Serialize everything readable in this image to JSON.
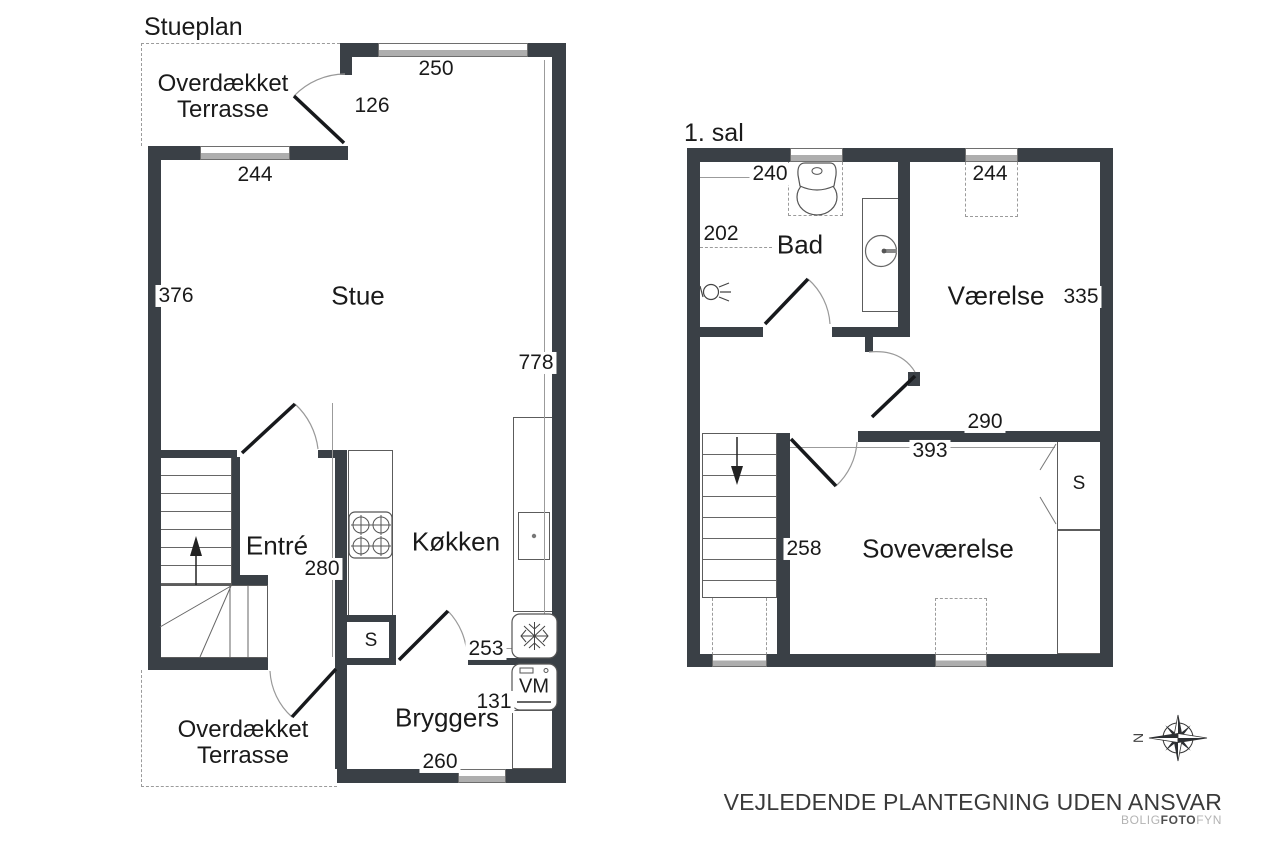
{
  "ground_floor": {
    "title": "Stueplan",
    "terrace_top": {
      "line1": "Overdækket",
      "line2": "Terrasse"
    },
    "terrace_bottom": {
      "line1": "Overdækket",
      "line2": "Terrasse"
    },
    "rooms": {
      "stue": "Stue",
      "entre": "Entré",
      "kokken": "Køkken",
      "bryggers": "Bryggers",
      "closet": "S"
    },
    "appliances": {
      "washer": "VM"
    },
    "dims": {
      "top_window": "250",
      "terrace_door": "126",
      "left_window": "244",
      "stue_side": "376",
      "right_side": "778",
      "entre_width": "280",
      "kokken_width": "253",
      "bryggers_depth": "131",
      "bryggers_width": "260"
    }
  },
  "first_floor": {
    "title": "1. sal",
    "rooms": {
      "bad": "Bad",
      "vaerelse": "Værelse",
      "sovevaerelse": "Soveværelse",
      "closet": "S"
    },
    "dims": {
      "left_window": "240",
      "bad_width": "202",
      "right_window": "244",
      "vaerelse_depth": "335",
      "vaerelse_width": "290",
      "sovevaerelse_width": "393",
      "stair_side": "258"
    }
  },
  "compass": {
    "north": "N"
  },
  "footer": {
    "disclaimer": "VEJLEDENDE PLANTEGNING UDEN ANSVAR",
    "brand": {
      "part1": "BOLIG",
      "part2": "FOTO",
      "part3": "FYN"
    }
  },
  "colors": {
    "wall": "#3a4046",
    "thin_line": "#5c5c5c",
    "dash": "#9b9b9b",
    "window_fill": "#aeaeae"
  }
}
